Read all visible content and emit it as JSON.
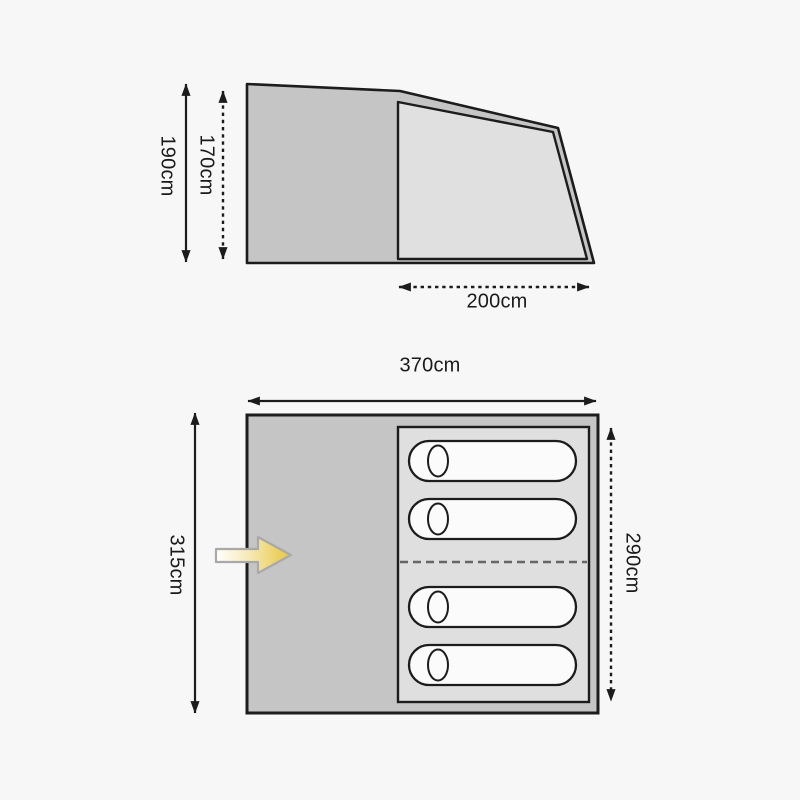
{
  "diagram_title": "tent-dimensions-diagram",
  "side_view": {
    "outer_height_label": "190cm",
    "inner_height_label": "170cm",
    "inner_width_label": "200cm"
  },
  "floor_plan": {
    "outer_width_label": "370cm",
    "outer_depth_label": "315cm",
    "inner_depth_label": "290cm",
    "sleeping_bag_count": 4
  },
  "colors": {
    "background": "#f7f7f7",
    "outer_fabric_gray": "#c5c5c5",
    "inner_area_gray": "#e0e0e0",
    "sleeping_bag_white": "#fbfbfb",
    "outline_black": "#1c1c1c",
    "divider_gray": "#666666",
    "entrance_arrow_yellow": "#e8c53d",
    "entrance_arrow_outline": "#a9a9a9"
  },
  "icons": {
    "entrance_arrow": "right-arrow",
    "dimension_arrowhead": "double-ended-arrow"
  }
}
